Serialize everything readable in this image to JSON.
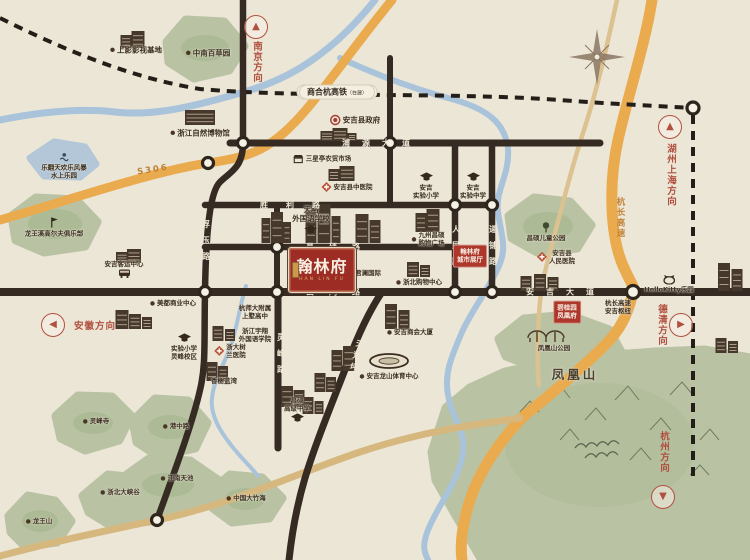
{
  "project_badge": {
    "name": "翰林府",
    "subtext": "HAN LIN FU"
  },
  "railway": {
    "label": "商合杭高铁",
    "status": "（在建）"
  },
  "colors": {
    "background": "#ece6d7",
    "road": "#352b22",
    "highway": "#eaaa4e",
    "river": "#a9c3da",
    "hill": "#b9c3a4",
    "accent_red": "#ae372c",
    "marker_red": "#b2503f"
  },
  "direction_markers": [
    {
      "id": "nanjing",
      "label": "南京方向",
      "arrow": "up",
      "cx": 256,
      "cy": 27,
      "tx": 256,
      "ty": 62,
      "vertical": true
    },
    {
      "id": "huzhou-shanghai",
      "label": "湖州上海方向",
      "arrow": "up",
      "cx": 670,
      "cy": 127,
      "tx": 670,
      "ty": 175,
      "vertical": true
    },
    {
      "id": "anhui",
      "label": "安徽方向",
      "arrow": "left",
      "cx": 53,
      "cy": 325,
      "tx": 95,
      "ty": 325,
      "vertical": false
    },
    {
      "id": "deqing",
      "label": "德清方向",
      "arrow": "right",
      "cx": 681,
      "cy": 325,
      "tx": 661,
      "ty": 325,
      "vertical": true
    },
    {
      "id": "hangzhou",
      "label": "杭州方向",
      "arrow": "down",
      "cx": 663,
      "cy": 497,
      "tx": 663,
      "ty": 452,
      "vertical": true
    }
  ],
  "road_labels": [
    {
      "id": "puyuan-dadao",
      "text": "浦源大道",
      "x": 376,
      "y": 143,
      "orient": "h",
      "spread": 12
    },
    {
      "id": "shengli-lu",
      "text": "胜利路",
      "x": 290,
      "y": 205,
      "orient": "h",
      "spread": 18
    },
    {
      "id": "changshuo-lu",
      "text": "昌硕路",
      "x": 333,
      "y": 247,
      "orient": "h",
      "spread": 15
    },
    {
      "id": "yunhong-lu",
      "text": "云鸿路",
      "x": 333,
      "y": 292,
      "orient": "h",
      "spread": 15
    },
    {
      "id": "anji-dadao",
      "text": "安吉大道",
      "x": 560,
      "y": 292,
      "orient": "h",
      "spread": 12
    },
    {
      "id": "fuyu-lu",
      "text": "浮玉路",
      "x": 206,
      "y": 240,
      "orient": "v",
      "spread": 8
    },
    {
      "id": "renmin-lu",
      "text": "人民路",
      "x": 456,
      "y": 245,
      "orient": "v",
      "spread": 8
    },
    {
      "id": "dipu-lu",
      "text": "递铺路",
      "x": 493,
      "y": 245,
      "orient": "v",
      "spread": 8
    },
    {
      "id": "lingfeng-lu",
      "text": "灵峰路",
      "x": 281,
      "y": 353,
      "orient": "v",
      "spread": 8
    },
    {
      "id": "tianhuangping-lu",
      "text": "天荒坪路",
      "x": 355,
      "y": 361,
      "orient": "v",
      "spread": 4,
      "rot": 14
    }
  ],
  "highway_labels": [
    {
      "id": "s306",
      "text": "S306",
      "x": 153,
      "y": 170,
      "orient": "h",
      "rot": -9
    },
    {
      "id": "hangchang-expwy",
      "text": "杭长高速",
      "x": 620,
      "y": 218,
      "orient": "v"
    }
  ],
  "red_labels": [
    {
      "id": "hanlinfu-city-hall",
      "text": "翰林府\n城市展厅",
      "x": 470,
      "y": 256
    },
    {
      "id": "biguiyuan-fenghuangfu",
      "text": "碧桂园\n凤凰府",
      "x": 567,
      "y": 312
    }
  ],
  "landmarks": [
    {
      "id": "shangying-film-base",
      "text": "上影影视基地",
      "x": 136,
      "y": 50,
      "icon": "dot",
      "side": "left"
    },
    {
      "id": "zhongnan-baicaoyuan",
      "text": "中南百草园",
      "x": 208,
      "y": 53,
      "icon": "dot",
      "side": "left"
    },
    {
      "id": "zhejiang-natural-museum",
      "text": "浙江自然博物馆",
      "x": 200,
      "y": 133,
      "icon": "dot",
      "side": "left"
    },
    {
      "id": "water-park",
      "text": "乐翻天欢乐风暴\n水上乐园",
      "x": 64,
      "y": 166,
      "icon": "swim",
      "side": "above",
      "small": true
    },
    {
      "id": "longwangxi-golf-club",
      "text": "龙王溪高尔夫俱乐部",
      "x": 54,
      "y": 227,
      "icon": "golf",
      "side": "above",
      "small": true
    },
    {
      "id": "anji-county-government",
      "text": "安吉县政府",
      "x": 355,
      "y": 120,
      "icon": "gov",
      "side": "left"
    },
    {
      "id": "sanxingting-market",
      "text": "三星亭农贸市场",
      "x": 322,
      "y": 159,
      "icon": "market",
      "side": "left",
      "small": true
    },
    {
      "id": "anji-tcm-hospital",
      "text": "安吉县中医院",
      "x": 347,
      "y": 187,
      "icon": "hospital",
      "side": "left",
      "small": true
    },
    {
      "id": "anji-exp-primary",
      "text": "安吉\n实验小学",
      "x": 426,
      "y": 186,
      "icon": "school",
      "side": "above",
      "small": true
    },
    {
      "id": "anji-exp-middle",
      "text": "安吉\n实验中学",
      "x": 473,
      "y": 186,
      "icon": "school",
      "side": "above",
      "small": true
    },
    {
      "id": "tianlue-school",
      "text": "天略\n外国语学校",
      "x": 311,
      "y": 220,
      "icon": "school",
      "side": "below"
    },
    {
      "id": "jiuzhou-changshuo-mall",
      "text": "九州昌硕\n购物广场",
      "x": 428,
      "y": 239,
      "icon": "dot",
      "side": "left",
      "small": true
    },
    {
      "id": "zhebei-shopping-center",
      "text": "浙北购物中心",
      "x": 419,
      "y": 282,
      "icon": "dot",
      "side": "left",
      "small": true
    },
    {
      "id": "junlan-international",
      "text": "君澜国际",
      "x": 368,
      "y": 273,
      "icon": "none",
      "side": "left",
      "small": true
    },
    {
      "id": "changshuo-children-park",
      "text": "昌硕儿童公园",
      "x": 546,
      "y": 232,
      "icon": "park",
      "side": "above",
      "small": true
    },
    {
      "id": "anji-peoples-hospital",
      "text": "安吉县\n人民医院",
      "x": 556,
      "y": 257,
      "icon": "hospital",
      "side": "left",
      "small": true
    },
    {
      "id": "hellokitty-park",
      "text": "HelloKitty乐园",
      "x": 669,
      "y": 284,
      "icon": "kitty",
      "side": "above",
      "small": true
    },
    {
      "id": "hangchang-anji-hub",
      "text": "杭长高速\n安吉枢纽",
      "x": 618,
      "y": 307,
      "icon": "none",
      "side": "left",
      "small": true
    },
    {
      "id": "fenghuangshan-park",
      "text": "凤凰山公园",
      "x": 554,
      "y": 348,
      "icon": "none",
      "side": "left",
      "small": true
    },
    {
      "id": "fenghuangshan",
      "text": "凤凰山",
      "x": 575,
      "y": 375,
      "icon": "none",
      "side": "left",
      "big": true
    },
    {
      "id": "anji-chamber-building",
      "text": "安吉商会大厦",
      "x": 410,
      "y": 332,
      "icon": "dot",
      "side": "left",
      "small": true
    },
    {
      "id": "longshan-sports-center",
      "text": "安吉龙山体育中心",
      "x": 389,
      "y": 376,
      "icon": "dot",
      "side": "left",
      "small": true
    },
    {
      "id": "changshuo-senior-high",
      "text": "昌硕\n高级中学",
      "x": 297,
      "y": 410,
      "icon": "school",
      "side": "below",
      "small": true
    },
    {
      "id": "anji-bus-terminal",
      "text": "安吉客运中心",
      "x": 124,
      "y": 269,
      "icon": "bus",
      "side": "below",
      "small": true
    },
    {
      "id": "meidu-business-center",
      "text": "美都商业中心",
      "x": 173,
      "y": 303,
      "icon": "dot",
      "side": "left",
      "small": true
    },
    {
      "id": "exp-primary-lingfeng",
      "text": "实验小学\n灵峰校区",
      "x": 184,
      "y": 347,
      "icon": "school",
      "side": "above",
      "small": true
    },
    {
      "id": "zheda-shulan-hospital",
      "text": "浙大树\n兰医院",
      "x": 230,
      "y": 351,
      "icon": "hospital",
      "side": "left",
      "small": true
    },
    {
      "id": "hangshida-shangshu-high",
      "text": "杭师大附属\n上墅高中",
      "x": 255,
      "y": 312,
      "icon": "none",
      "side": "left",
      "small": true
    },
    {
      "id": "yuxiang-college",
      "text": "浙江宇翔\n外国语学院",
      "x": 255,
      "y": 335,
      "icon": "none",
      "side": "left",
      "small": true
    },
    {
      "id": "xiangxie-lanwan",
      "text": "香榭蓝湾",
      "x": 224,
      "y": 381,
      "icon": "none",
      "side": "left",
      "small": true
    },
    {
      "id": "lingfeng-temple",
      "text": "灵峰寺",
      "x": 96,
      "y": 421,
      "icon": "dot",
      "side": "left",
      "small": true
    },
    {
      "id": "gangzhong-lu-hill",
      "text": "港中路",
      "x": 176,
      "y": 426,
      "icon": "dot",
      "side": "left",
      "small": true
    },
    {
      "id": "jiangnan-tianchi",
      "text": "江南天池",
      "x": 177,
      "y": 478,
      "icon": "dot",
      "side": "left",
      "small": true
    },
    {
      "id": "zhebei-grand-canyon",
      "text": "浙北大峡谷",
      "x": 120,
      "y": 492,
      "icon": "dot",
      "side": "left",
      "small": true
    },
    {
      "id": "longwangshan",
      "text": "龙王山",
      "x": 39,
      "y": 521,
      "icon": "dot",
      "side": "left",
      "small": true
    },
    {
      "id": "china-bamboo-sea",
      "text": "中国大竹海",
      "x": 246,
      "y": 498,
      "icon": "dot",
      "side": "left",
      "small": true
    }
  ]
}
